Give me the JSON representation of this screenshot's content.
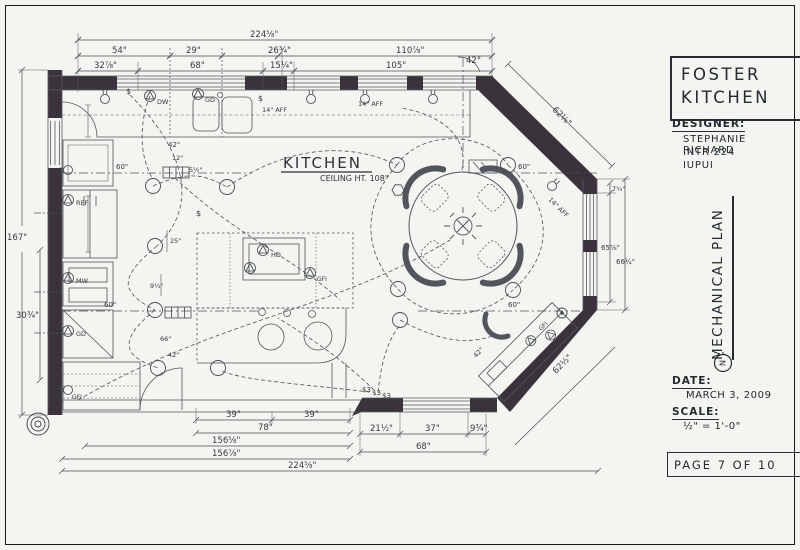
{
  "title_block": {
    "project_line1": "FOSTER",
    "project_line2": "KITCHEN",
    "designer_label": "DESIGNER:",
    "designer_name": "STEPHANIE RICHARD",
    "designer_course": "INTR 224",
    "designer_school": "IUPUI",
    "plan_title": "MECHANICAL PLAN",
    "north_letter": "N",
    "date_label": "DATE:",
    "date_value": "MARCH 3, 2009",
    "scale_label": "SCALE:",
    "scale_value": "½\" = 1'-0\"",
    "page_label": "PAGE 7 OF 10"
  },
  "plan": {
    "room_name": "KITCHEN",
    "ceiling_note": "CEILING HT. 108\"",
    "labels": [
      {
        "x": 250,
        "y": 37,
        "t": "224⅝\""
      },
      {
        "x": 112,
        "y": 53,
        "t": "54\""
      },
      {
        "x": 186,
        "y": 53,
        "t": "29\""
      },
      {
        "x": 268,
        "y": 53,
        "t": "26¾\""
      },
      {
        "x": 396,
        "y": 53,
        "t": "110⅞\""
      },
      {
        "x": 94,
        "y": 68,
        "t": "32⅞\""
      },
      {
        "x": 190,
        "y": 68,
        "t": "68\""
      },
      {
        "x": 270,
        "y": 68,
        "t": "15¼\""
      },
      {
        "x": 386,
        "y": 68,
        "t": "105\""
      },
      {
        "x": 466,
        "y": 63,
        "t": "42°"
      },
      {
        "x": 552,
        "y": 110,
        "t": "62⅛\"",
        "r": 45
      },
      {
        "x": 612,
        "y": 191,
        "t": "7¾\"",
        "s": 6.5
      },
      {
        "x": 601,
        "y": 250,
        "t": "65⅝\"",
        "s": 7
      },
      {
        "x": 616,
        "y": 264,
        "t": "66¾\"",
        "s": 7
      },
      {
        "x": 556,
        "y": 374,
        "t": "62½\"",
        "r": -45
      },
      {
        "x": 226,
        "y": 417,
        "t": "39\""
      },
      {
        "x": 304,
        "y": 417,
        "t": "39\""
      },
      {
        "x": 258,
        "y": 430,
        "t": "78\""
      },
      {
        "x": 212,
        "y": 443,
        "t": "156⅝\""
      },
      {
        "x": 212,
        "y": 456,
        "t": "156⅞\""
      },
      {
        "x": 288,
        "y": 468,
        "t": "224⅝\""
      },
      {
        "x": 370,
        "y": 431,
        "t": "21½\""
      },
      {
        "x": 425,
        "y": 431,
        "t": "37\""
      },
      {
        "x": 470,
        "y": 431,
        "t": "9¾\""
      },
      {
        "x": 416,
        "y": 449,
        "t": "68\""
      },
      {
        "x": 7,
        "y": 240,
        "t": "167\""
      },
      {
        "x": 16,
        "y": 318,
        "t": "30¾\""
      },
      {
        "x": 116,
        "y": 169,
        "t": "60\"",
        "s": 7
      },
      {
        "x": 104,
        "y": 307,
        "t": "60\"",
        "s": 7
      },
      {
        "x": 518,
        "y": 169,
        "t": "60\"",
        "s": 7
      },
      {
        "x": 508,
        "y": 307,
        "t": "60\"",
        "s": 7
      },
      {
        "x": 168,
        "y": 147,
        "t": "42\"",
        "s": 7
      },
      {
        "x": 172,
        "y": 160,
        "t": "12\"",
        "s": 6.5
      },
      {
        "x": 189,
        "y": 172,
        "t": "5½\"",
        "s": 6.5
      },
      {
        "x": 170,
        "y": 243,
        "t": "25\"",
        "s": 6.5
      },
      {
        "x": 150,
        "y": 288,
        "t": "9¼\"",
        "s": 6.5
      },
      {
        "x": 160,
        "y": 341,
        "t": "66\"",
        "s": 6.5
      },
      {
        "x": 168,
        "y": 357,
        "t": "42\"",
        "s": 6.5
      },
      {
        "x": 476,
        "y": 358,
        "t": "42\"",
        "s": 6.5,
        "r": -45
      },
      {
        "x": 358,
        "y": 106,
        "t": "14\" AFF",
        "s": 6.5,
        "n": "aff-note"
      },
      {
        "x": 262,
        "y": 112,
        "t": "14\" AFF",
        "s": 6.5,
        "n": "aff-note"
      },
      {
        "x": 548,
        "y": 200,
        "t": "14\" AFF",
        "s": 6.5,
        "r": 45,
        "n": "aff-note"
      },
      {
        "x": 157,
        "y": 104,
        "t": "DW",
        "s": 6.5,
        "n": "outlet-label-dishwasher"
      },
      {
        "x": 205,
        "y": 102,
        "t": "GD",
        "s": 6.5,
        "n": "outlet-label-disposal"
      },
      {
        "x": 76,
        "y": 205,
        "t": "REF",
        "s": 6.5,
        "n": "outlet-label-refrigerator"
      },
      {
        "x": 76,
        "y": 283,
        "t": "MW",
        "s": 6.5,
        "n": "outlet-label-microwave"
      },
      {
        "x": 76,
        "y": 336,
        "t": "GD",
        "s": 6.5,
        "n": "outlet-label"
      },
      {
        "x": 271,
        "y": 257,
        "t": "HD",
        "s": 6.5,
        "n": "outlet-label-hood"
      },
      {
        "x": 317,
        "y": 281,
        "t": "GFI",
        "s": 6,
        "n": "outlet-label-gfi"
      },
      {
        "x": 72,
        "y": 399,
        "t": "GFI",
        "s": 6,
        "n": "outlet-label-gfi"
      },
      {
        "x": 541,
        "y": 331,
        "t": "GFI",
        "s": 6,
        "r": -45,
        "n": "outlet-label-gfi"
      },
      {
        "x": 362,
        "y": 392,
        "t": "$3",
        "s": 7,
        "n": "switch-symbol"
      },
      {
        "x": 372,
        "y": 395,
        "t": "$3",
        "s": 7,
        "n": "switch-symbol"
      },
      {
        "x": 382,
        "y": 398,
        "t": "$3",
        "s": 7,
        "n": "switch-symbol"
      },
      {
        "x": 196,
        "y": 216,
        "t": "$",
        "s": 8,
        "n": "switch-symbol"
      },
      {
        "x": 126,
        "y": 94,
        "t": "$",
        "s": 8,
        "n": "switch-symbol"
      },
      {
        "x": 258,
        "y": 101,
        "t": "$",
        "s": 8,
        "n": "switch-symbol"
      }
    ]
  }
}
